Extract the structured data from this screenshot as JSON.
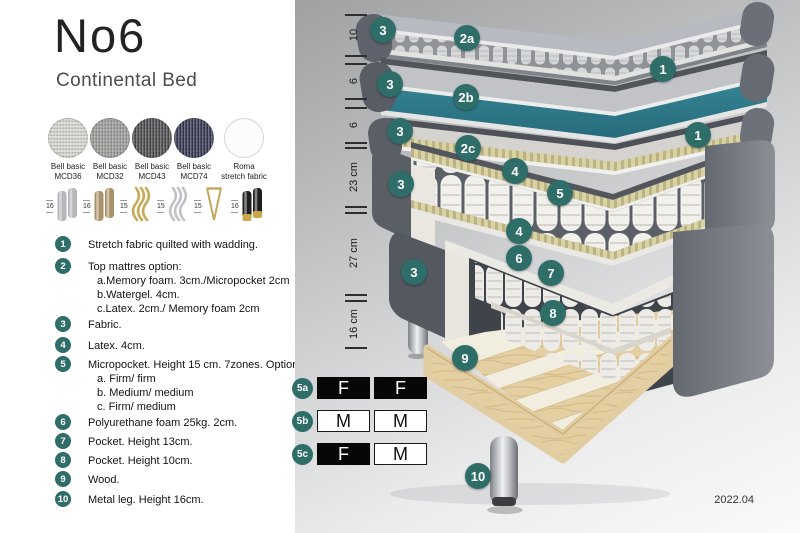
{
  "header": {
    "title": "No6",
    "subtitle": "Continental Bed"
  },
  "fabrics": [
    {
      "line1": "Bell basic",
      "line2": "MCD36",
      "color": "#d7d6d1"
    },
    {
      "line1": "Bell basic",
      "line2": "MCD32",
      "color": "#9b9c98"
    },
    {
      "line1": "Bell basic",
      "line2": "MCD43",
      "color": "#4b4c4e"
    },
    {
      "line1": "Bell basic",
      "line2": "MCD74",
      "color": "#343651"
    },
    {
      "line1": "Roma",
      "line2": "stretch fabric",
      "color": "#fcfcfc"
    }
  ],
  "legs": [
    {
      "height": "16",
      "type": "cylinder",
      "color": "#b4b7bb"
    },
    {
      "height": "16",
      "type": "cylinder",
      "color": "#a99269"
    },
    {
      "height": "15",
      "type": "twisted",
      "color": "#c6ac5a"
    },
    {
      "height": "15",
      "type": "twisted",
      "color": "#bfc2c6"
    },
    {
      "height": "15",
      "type": "hairpin",
      "color": "#c2a85e"
    },
    {
      "height": "16",
      "type": "cylinder-tip",
      "color": "#1f1f22",
      "tip_color": "#c9a84c"
    }
  ],
  "legend": {
    "items": [
      {
        "num": "1",
        "text": "Stretch fabric quilted with wadding.",
        "subs": []
      },
      {
        "num": "2",
        "text": "Top mattres option:",
        "subs": [
          "a.Memory foam. 3cm./Micropocket 2cm",
          "b.Watergel. 4cm.",
          "c.Latex. 2cm./ Memory foam 2cm"
        ]
      },
      {
        "num": "3",
        "text": "Fabric.",
        "subs": []
      },
      {
        "num": "4",
        "text": "Latex. 4cm.",
        "subs": []
      },
      {
        "num": "5",
        "text": "Micropocket. Height 15 cm. 7zones. Option:",
        "subs": [
          "a. Firm/ firm",
          "b. Medium/ medium",
          "c. Firm/ medium"
        ]
      },
      {
        "num": "6",
        "text": "Polyurethane foam 25kg. 2cm.",
        "subs": []
      },
      {
        "num": "7",
        "text": "Pocket. Height 13cm.",
        "subs": []
      },
      {
        "num": "8",
        "text": "Pocket. Height 10cm.",
        "subs": []
      },
      {
        "num": "9",
        "text": "Wood.",
        "subs": []
      },
      {
        "num": "10",
        "text": "Metal leg. Height 16cm.",
        "subs": []
      }
    ]
  },
  "diagram": {
    "ruler_labels": [
      "10",
      "6",
      "6",
      "23 cm",
      "27 cm",
      "16 cm"
    ],
    "badges": [
      "3",
      "2a",
      "1",
      "3",
      "2b",
      "1",
      "3",
      "2c",
      "4",
      "3",
      "5",
      "4",
      "6",
      "3",
      "7",
      "8",
      "9",
      "10"
    ],
    "firmness_table": {
      "rows": [
        {
          "id": "5a",
          "cells": [
            {
              "text": "F",
              "variant": "dark"
            },
            {
              "text": "F",
              "variant": "dark"
            }
          ]
        },
        {
          "id": "5b",
          "cells": [
            {
              "text": "M",
              "variant": "light"
            },
            {
              "text": "M",
              "variant": "light"
            }
          ]
        },
        {
          "id": "5c",
          "cells": [
            {
              "text": "F",
              "variant": "dark"
            },
            {
              "text": "M",
              "variant": "light"
            }
          ]
        }
      ]
    },
    "version": "2022.04",
    "colors": {
      "badge": "#2f6e68",
      "watergel": "#2e7b8b",
      "latex": "#d0c89b",
      "wood": "#e3cda2",
      "upholstery": "#5e626a"
    }
  }
}
